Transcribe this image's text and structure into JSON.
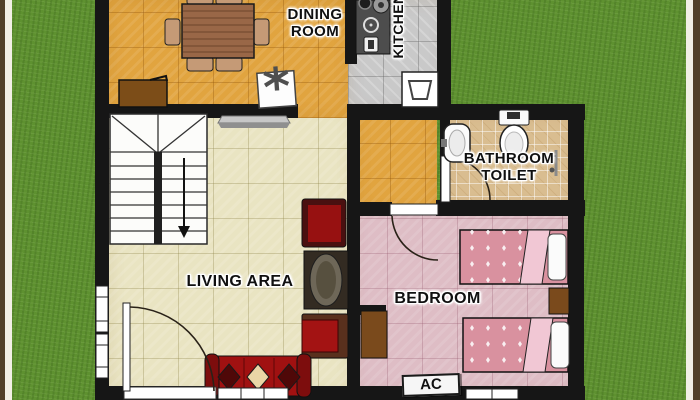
{
  "plan": {
    "title": "House floor plan",
    "rooms": {
      "dining_room": {
        "name": "DINING ROOM",
        "floor_color": "#e1a43f"
      },
      "kitchen": {
        "name": "KITCHEN",
        "floor_color": "#c9c9c9"
      },
      "bathroom": {
        "name": "BATHROOM TOILET",
        "floor_color": "#d9bd90"
      },
      "living_area": {
        "name": "LIVING AREA",
        "floor_color": "#e9e4c2"
      },
      "bedroom": {
        "name": "BEDROOM",
        "floor_color": "#debdc5"
      },
      "hallway": {
        "floor_color": "#e1a43f"
      }
    },
    "labels": {
      "dining_line1": "DINING",
      "dining_line2": "ROOM",
      "kitchen": "KITCHEN",
      "bathroom_line1": "BATHROOM",
      "bathroom_line2": "TOILET",
      "living": "LIVING AREA",
      "bedroom": "BEDROOM",
      "ac": "AC"
    },
    "icons": {
      "cooler_fan_symbol": "*",
      "laundry_basin": "basin-icon",
      "stairs_direction": "down-arrow-icon"
    },
    "palette": {
      "grass": "#5e9130",
      "wall": "#161616",
      "frame_brown": "#52402a",
      "frame_white": "#f2efe6",
      "sofa_red": "#a01111",
      "wood_brown": "#7a4a1c",
      "bed_pink": "#d9919f"
    }
  }
}
